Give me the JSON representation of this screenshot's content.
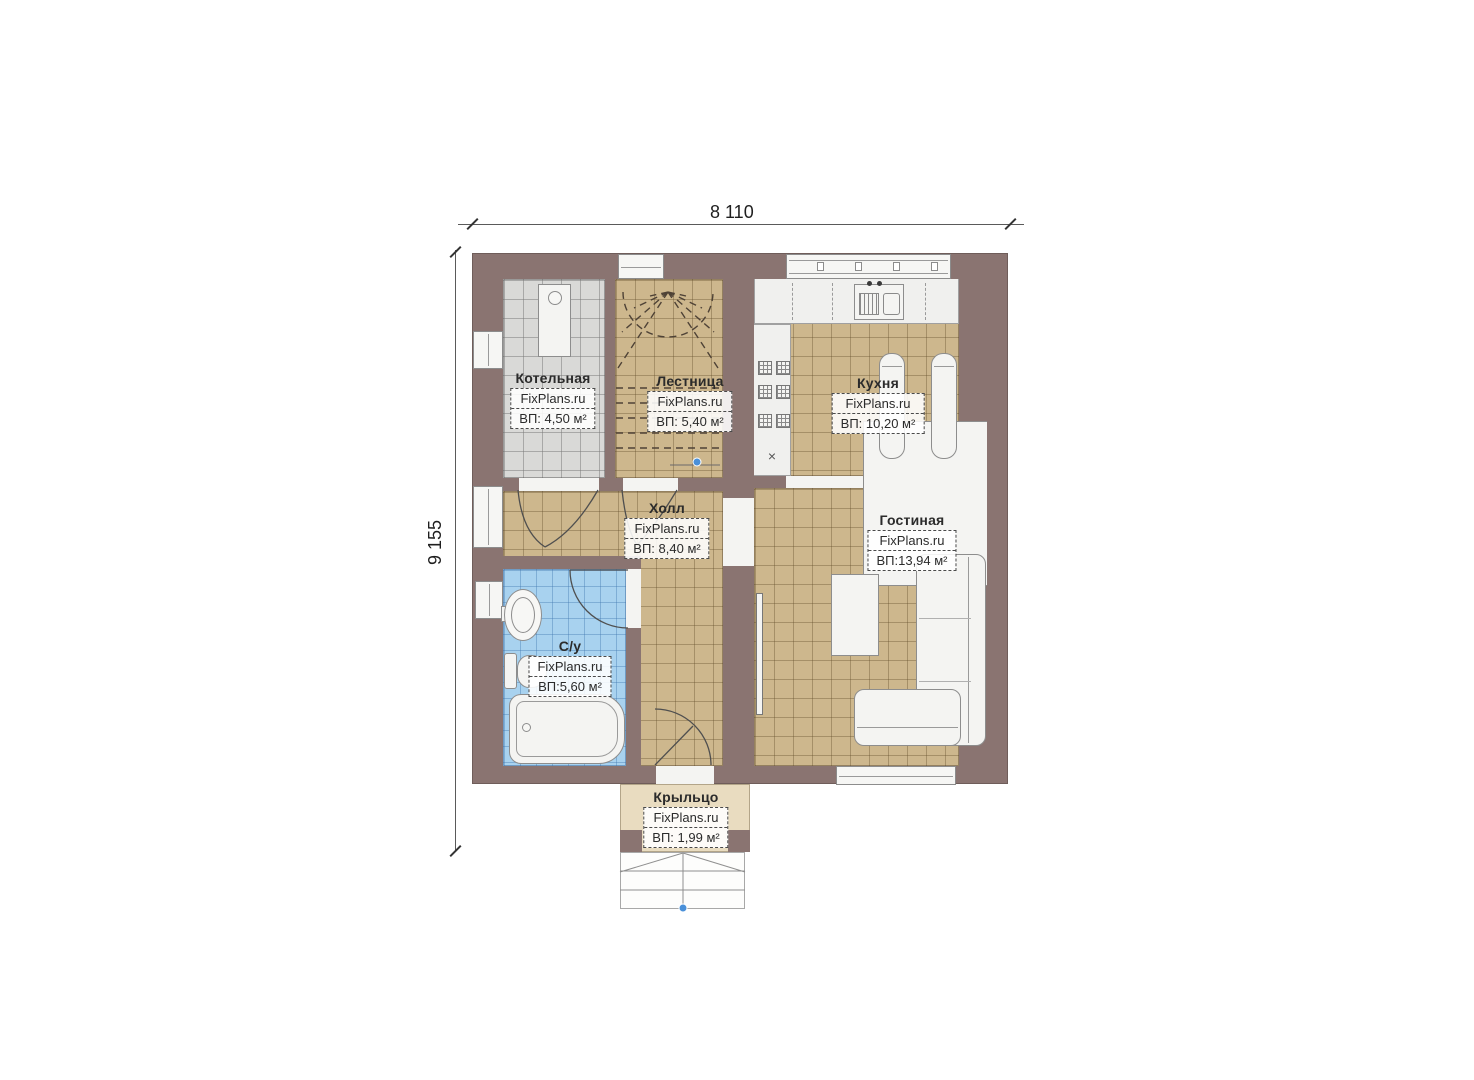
{
  "dimensions": {
    "width": "8 110",
    "height": "9 155"
  },
  "rooms": [
    {
      "name": "Котельная",
      "watermark": "FixPlans.ru",
      "area": "ВП: 4,50 м²"
    },
    {
      "name": "Лестница",
      "watermark": "FixPlans.ru",
      "area": "ВП: 5,40 м²"
    },
    {
      "name": "Кухня",
      "watermark": "FixPlans.ru",
      "area": "ВП: 10,20 м²"
    },
    {
      "name": "Холл",
      "watermark": "FixPlans.ru",
      "area": "ВП: 8,40 м²"
    },
    {
      "name": "Гостиная",
      "watermark": "FixPlans.ru",
      "area": "ВП:13,94 м²"
    },
    {
      "name": "С/у",
      "watermark": "FixPlans.ru",
      "area": "ВП:5,60 м²"
    },
    {
      "name": "Крыльцо",
      "watermark": "FixPlans.ru",
      "area": "ВП: 1,99 м²"
    }
  ],
  "symbols": {
    "stove_mark": "×"
  },
  "colors": {
    "wall": "#8a7471",
    "floor_tan": "#cdb78d",
    "floor_gray": "#d9d9d7",
    "floor_blue": "#a8d2ef",
    "porch": "#e9dcc0",
    "marker_blue": "#4a90d9"
  }
}
